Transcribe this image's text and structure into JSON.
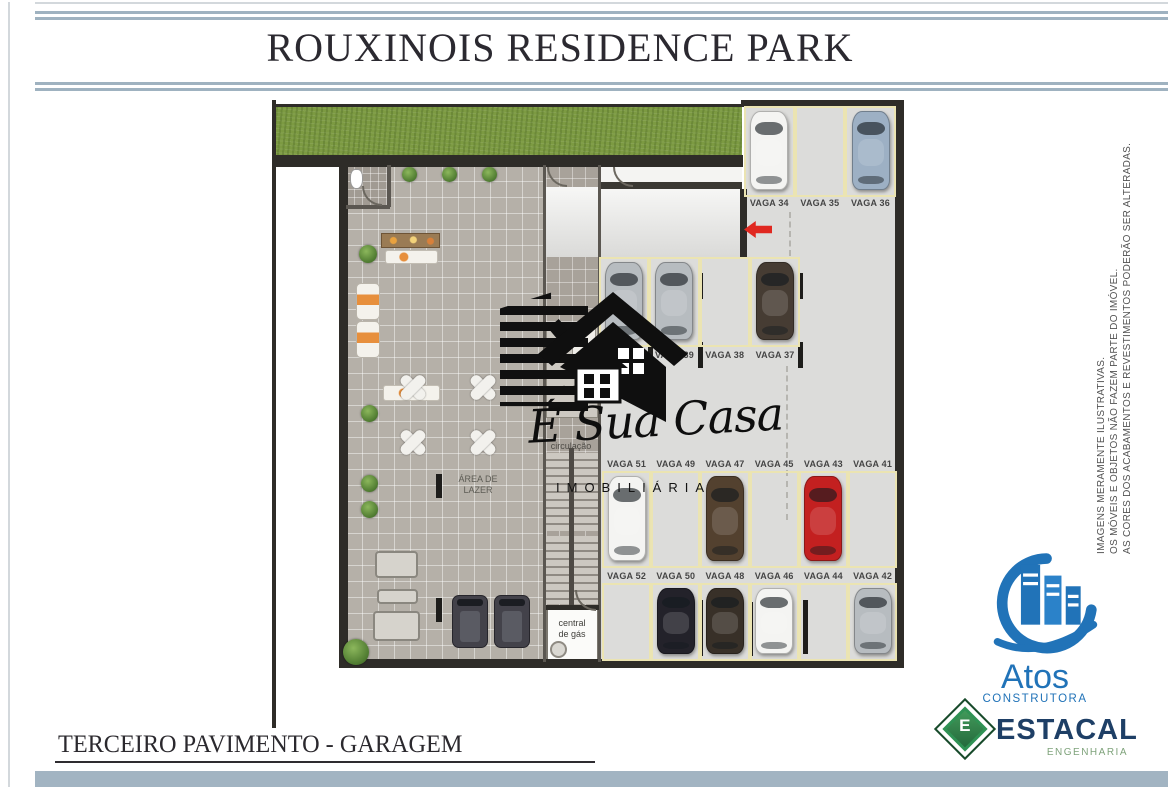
{
  "header": {
    "title": "ROUXINOIS RESIDENCE PARK"
  },
  "footer": {
    "label": "TERCEIRO PAVIMENTO - GARAGEM"
  },
  "side_note": {
    "lines": [
      "IMAGENS MERAMENTE ILUSTRATIVAS.",
      "OS MÓVEIS E OBJETOS NÃO FAZEM PARTE DO IMÓVEL.",
      "AS CORES DOS ACABAMENTOS E REVESTIMENTOS PODERÃO SER ALTERADAS."
    ]
  },
  "watermark": {
    "script_text": "É Sua Casa",
    "subtitle": "IMOBILIÁRIA"
  },
  "logos": {
    "atos": {
      "name": "Atos",
      "tagline": "CONSTRUTORA",
      "blue": "#2173b8"
    },
    "estacal": {
      "name": "ESTACAL",
      "tagline": "ENGENHARIA",
      "icon_letter": "E",
      "navy": "#1e3f66",
      "green": "#2f9254"
    }
  },
  "plan": {
    "room_labels": {
      "area_lazer": [
        "ÁREA DE",
        "LAZER"
      ],
      "circulacao": "circulação",
      "hall": "hall",
      "central_gas": [
        "central",
        "de gás"
      ]
    },
    "arrow": {
      "direction": "left",
      "color": "#e02820"
    },
    "car_colors": {
      "white": "#f4f4f2",
      "silver": "#b7bcc0",
      "steel_blue": "#9db0c4",
      "dark_brown": "#463c33",
      "brown": "#53412f",
      "red": "#c32020",
      "black": "#23222a",
      "dark_sedan": "#383028"
    },
    "parking_rows": [
      {
        "id": "row-a",
        "spaces": [
          {
            "label": "VAGA 34",
            "car": "white"
          },
          {
            "label": "VAGA 35",
            "car": null
          },
          {
            "label": "VAGA 36",
            "car": "steel_blue"
          }
        ]
      },
      {
        "id": "row-b",
        "spaces": [
          {
            "label": "",
            "car": "silver"
          },
          {
            "label": "VAGA 39",
            "car": "silver"
          },
          {
            "label": "VAGA 38",
            "car": null
          },
          {
            "label": "VAGA 37",
            "car": "dark_brown"
          }
        ]
      },
      {
        "id": "row-c",
        "spaces": [
          {
            "label": "VAGA 51",
            "car": "white"
          },
          {
            "label": "VAGA 49",
            "car": null
          },
          {
            "label": "VAGA 47",
            "car": "brown"
          },
          {
            "label": "VAGA 45",
            "car": null
          },
          {
            "label": "VAGA 43",
            "car": "red"
          },
          {
            "label": "VAGA 41",
            "car": null
          }
        ]
      },
      {
        "id": "row-d",
        "spaces": [
          {
            "label": "VAGA 52",
            "car": null
          },
          {
            "label": "VAGA 50",
            "car": "black"
          },
          {
            "label": "VAGA 48",
            "car": "dark_sedan"
          },
          {
            "label": "VAGA 46",
            "car": "white"
          },
          {
            "label": "VAGA 44",
            "car": null
          },
          {
            "label": "VAGA 42",
            "car": "silver"
          }
        ]
      }
    ]
  }
}
